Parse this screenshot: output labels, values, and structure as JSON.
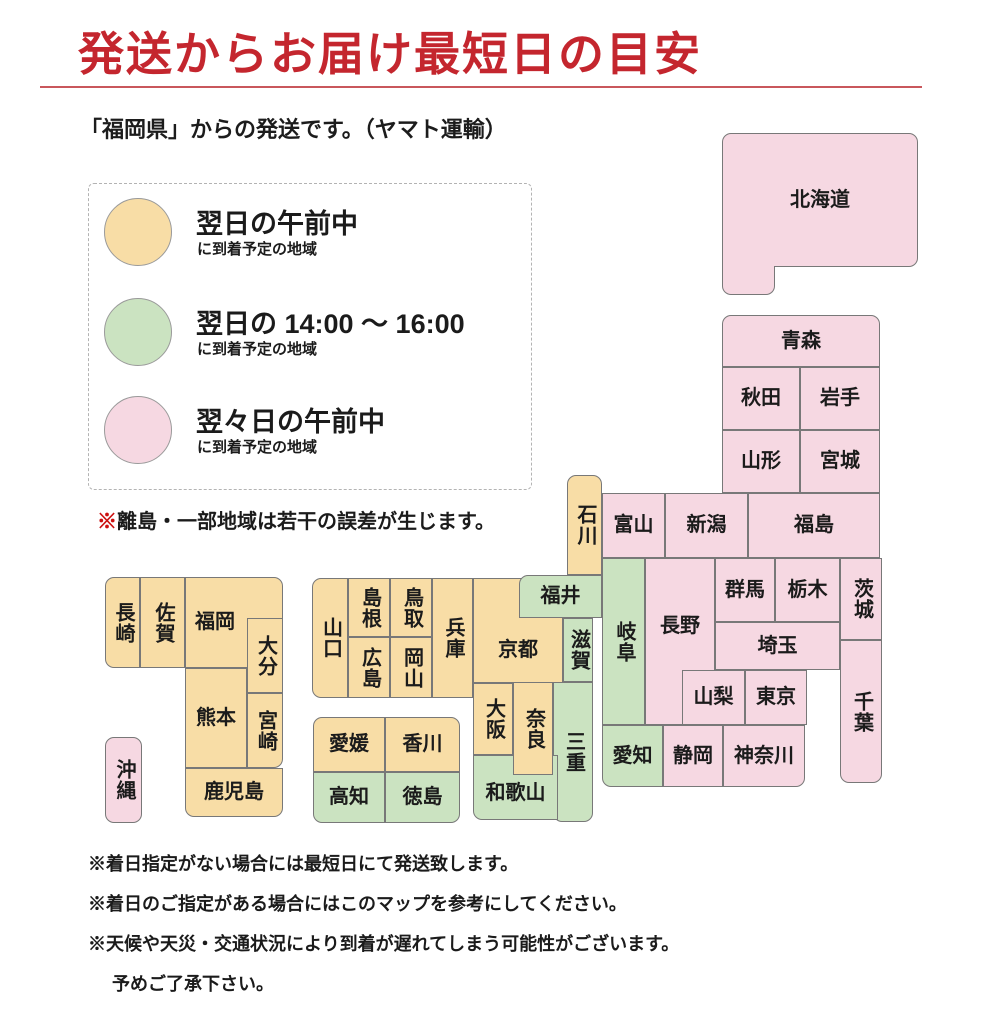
{
  "header": {
    "title": "発送からお届け最短日の目安",
    "title_color": "#c4262e",
    "subtitle": "「福岡県」からの発送です。（ヤマト運輸）"
  },
  "legend": {
    "items": [
      {
        "color": "#f8dda6",
        "title": "翌日の午前中",
        "sub": "に到着予定の地域"
      },
      {
        "color": "#cbe3c1",
        "title": "翌日の 14:00 ～ 16:00",
        "sub": "に到着予定の地域"
      },
      {
        "color": "#f6d8e2",
        "title": "翌々日の午前中",
        "sub": "に到着予定の地域"
      }
    ],
    "note_mark": "※",
    "note": "離島・一部地域は若干の誤差が生じます。"
  },
  "map": {
    "colors": {
      "o": "#f8dda6",
      "g": "#cbe3c1",
      "p": "#f6d8e2"
    },
    "border_color": "#787878",
    "legend_meaning": {
      "o": "next-day-morning",
      "g": "next-day-14-16",
      "p": "two-days-morning"
    },
    "tiles": [
      {
        "name": "hokkaido",
        "label": "北海道",
        "x": 722,
        "y": 133,
        "w": 196,
        "h": 134,
        "c": "p",
        "rad": "tl tr br"
      },
      {
        "name": "hokkaido-leg",
        "label": "",
        "x": 722,
        "y": 266,
        "w": 53,
        "h": 29,
        "c": "p",
        "nb": "t",
        "rad": "bl br"
      },
      {
        "name": "aomori",
        "label": "青森",
        "x": 722,
        "y": 315,
        "w": 158,
        "h": 52,
        "c": "p",
        "rad": "tl tr"
      },
      {
        "name": "akita",
        "label": "秋田",
        "x": 722,
        "y": 367,
        "w": 78,
        "h": 63,
        "c": "p"
      },
      {
        "name": "iwate",
        "label": "岩手",
        "x": 800,
        "y": 367,
        "w": 80,
        "h": 63,
        "c": "p"
      },
      {
        "name": "yamagata",
        "label": "山形",
        "x": 722,
        "y": 430,
        "w": 78,
        "h": 63,
        "c": "p"
      },
      {
        "name": "miyagi",
        "label": "宮城",
        "x": 800,
        "y": 430,
        "w": 80,
        "h": 63,
        "c": "p"
      },
      {
        "name": "ishikawa",
        "label": "石川",
        "x": 567,
        "y": 475,
        "w": 35,
        "h": 100,
        "c": "o",
        "v": true,
        "rad": "tl tr"
      },
      {
        "name": "toyama",
        "label": "富山",
        "x": 602,
        "y": 493,
        "w": 63,
        "h": 65,
        "c": "p"
      },
      {
        "name": "niigata",
        "label": "新潟",
        "x": 665,
        "y": 493,
        "w": 83,
        "h": 65,
        "c": "p"
      },
      {
        "name": "fukushima",
        "label": "福島",
        "x": 748,
        "y": 493,
        "w": 132,
        "h": 65,
        "c": "p"
      },
      {
        "name": "gunma",
        "label": "群馬",
        "x": 715,
        "y": 558,
        "w": 60,
        "h": 64,
        "c": "p"
      },
      {
        "name": "tochigi",
        "label": "栃木",
        "x": 775,
        "y": 558,
        "w": 65,
        "h": 64,
        "c": "p"
      },
      {
        "name": "ibaraki",
        "label": "茨城",
        "x": 840,
        "y": 558,
        "w": 42,
        "h": 82,
        "c": "p",
        "v": true
      },
      {
        "name": "saitama",
        "label": "埼玉",
        "x": 715,
        "y": 622,
        "w": 125,
        "h": 48,
        "c": "p"
      },
      {
        "name": "chiba",
        "label": "千葉",
        "x": 840,
        "y": 640,
        "w": 42,
        "h": 143,
        "c": "p",
        "v": true,
        "rad": "bl br"
      },
      {
        "name": "nagano",
        "label": "長野",
        "x": 645,
        "y": 558,
        "w": 70,
        "h": 167,
        "c": "p",
        "pb": 30
      },
      {
        "name": "yamanashi",
        "label": "山梨",
        "x": 682,
        "y": 670,
        "w": 63,
        "h": 55,
        "c": "p"
      },
      {
        "name": "tokyo",
        "label": "東京",
        "x": 745,
        "y": 670,
        "w": 62,
        "h": 55,
        "c": "p"
      },
      {
        "name": "kanagawa",
        "label": "神奈川",
        "x": 723,
        "y": 725,
        "w": 82,
        "h": 62,
        "c": "p",
        "rad": "br"
      },
      {
        "name": "shizuoka",
        "label": "静岡",
        "x": 663,
        "y": 725,
        "w": 60,
        "h": 62,
        "c": "p"
      },
      {
        "name": "aichi",
        "label": "愛知",
        "x": 602,
        "y": 725,
        "w": 61,
        "h": 62,
        "c": "g",
        "rad": "bl"
      },
      {
        "name": "gifu",
        "label": "岐阜",
        "x": 602,
        "y": 558,
        "w": 43,
        "h": 167,
        "c": "g",
        "v": true
      },
      {
        "name": "kyoto",
        "label": "京都",
        "x": 473,
        "y": 578,
        "w": 90,
        "h": 105,
        "c": "o",
        "pt": 40
      },
      {
        "name": "fukui",
        "label": "福井",
        "x": 519,
        "y": 575,
        "w": 83,
        "h": 43,
        "c": "g",
        "rad": "tl"
      },
      {
        "name": "shiga",
        "label": "滋賀",
        "x": 563,
        "y": 618,
        "w": 30,
        "h": 64,
        "c": "g",
        "v": true
      },
      {
        "name": "mie",
        "label": "三重",
        "x": 553,
        "y": 682,
        "w": 40,
        "h": 140,
        "c": "g",
        "v": true,
        "rad": "bl br"
      },
      {
        "name": "wakayama",
        "label": "和歌山",
        "x": 473,
        "y": 755,
        "w": 85,
        "h": 65,
        "c": "g",
        "pt": 12,
        "rad": "bl"
      },
      {
        "name": "osaka",
        "label": "大阪",
        "x": 473,
        "y": 683,
        "w": 40,
        "h": 72,
        "c": "o",
        "v": true
      },
      {
        "name": "nara",
        "label": "奈良",
        "x": 513,
        "y": 682,
        "w": 40,
        "h": 93,
        "c": "o",
        "v": true
      },
      {
        "name": "hyogo",
        "label": "兵庫",
        "x": 432,
        "y": 578,
        "w": 41,
        "h": 120,
        "c": "o",
        "v": true
      },
      {
        "name": "tottori",
        "label": "鳥取",
        "x": 390,
        "y": 578,
        "w": 42,
        "h": 59,
        "c": "o",
        "v": true
      },
      {
        "name": "okayama",
        "label": "岡山",
        "x": 390,
        "y": 637,
        "w": 42,
        "h": 61,
        "c": "o",
        "v": true
      },
      {
        "name": "shimane",
        "label": "島根",
        "x": 348,
        "y": 578,
        "w": 42,
        "h": 59,
        "c": "o",
        "v": true
      },
      {
        "name": "hiroshima",
        "label": "広島",
        "x": 348,
        "y": 637,
        "w": 42,
        "h": 61,
        "c": "o",
        "v": true
      },
      {
        "name": "yamaguchi",
        "label": "山口",
        "x": 312,
        "y": 578,
        "w": 36,
        "h": 120,
        "c": "o",
        "v": true,
        "rad": "tl bl"
      },
      {
        "name": "ehime",
        "label": "愛媛",
        "x": 313,
        "y": 717,
        "w": 72,
        "h": 55,
        "c": "o",
        "rad": "tl"
      },
      {
        "name": "kagawa",
        "label": "香川",
        "x": 385,
        "y": 717,
        "w": 75,
        "h": 55,
        "c": "o",
        "rad": "tr"
      },
      {
        "name": "kochi",
        "label": "高知",
        "x": 313,
        "y": 772,
        "w": 72,
        "h": 51,
        "c": "g",
        "rad": "bl"
      },
      {
        "name": "tokushima",
        "label": "徳島",
        "x": 385,
        "y": 772,
        "w": 75,
        "h": 51,
        "c": "g",
        "rad": "br"
      },
      {
        "name": "fukuoka",
        "label": "福岡",
        "x": 185,
        "y": 577,
        "w": 98,
        "h": 91,
        "c": "o",
        "pr": 38,
        "rad": "tr"
      },
      {
        "name": "oita",
        "label": "大分",
        "x": 247,
        "y": 618,
        "w": 36,
        "h": 75,
        "c": "o",
        "v": true
      },
      {
        "name": "nagasaki",
        "label": "長崎",
        "x": 105,
        "y": 577,
        "w": 35,
        "h": 91,
        "c": "o",
        "v": true,
        "rad": "tl bl"
      },
      {
        "name": "saga",
        "label": "佐賀",
        "x": 140,
        "y": 577,
        "w": 45,
        "h": 91,
        "c": "o",
        "v": true
      },
      {
        "name": "kumamoto",
        "label": "熊本",
        "x": 185,
        "y": 668,
        "w": 62,
        "h": 100,
        "c": "o"
      },
      {
        "name": "miyazaki",
        "label": "宮崎",
        "x": 247,
        "y": 693,
        "w": 36,
        "h": 75,
        "c": "o",
        "v": true,
        "rad": "br"
      },
      {
        "name": "kagoshima",
        "label": "鹿児島",
        "x": 185,
        "y": 768,
        "w": 98,
        "h": 49,
        "c": "o",
        "rad": "bl br"
      },
      {
        "name": "okinawa",
        "label": "沖縄",
        "x": 105,
        "y": 737,
        "w": 37,
        "h": 86,
        "c": "p",
        "v": true,
        "rad": "tl tr bl br"
      }
    ]
  },
  "footnotes": {
    "lines": [
      "※着日指定がない場合には最短日にて発送致します。",
      "※着日のご指定がある場合にはこのマップを参考にしてください。",
      "※天候や天災・交通状況により到着が遅れてしまう可能性がございます。",
      "予めご了承下さい。"
    ]
  }
}
